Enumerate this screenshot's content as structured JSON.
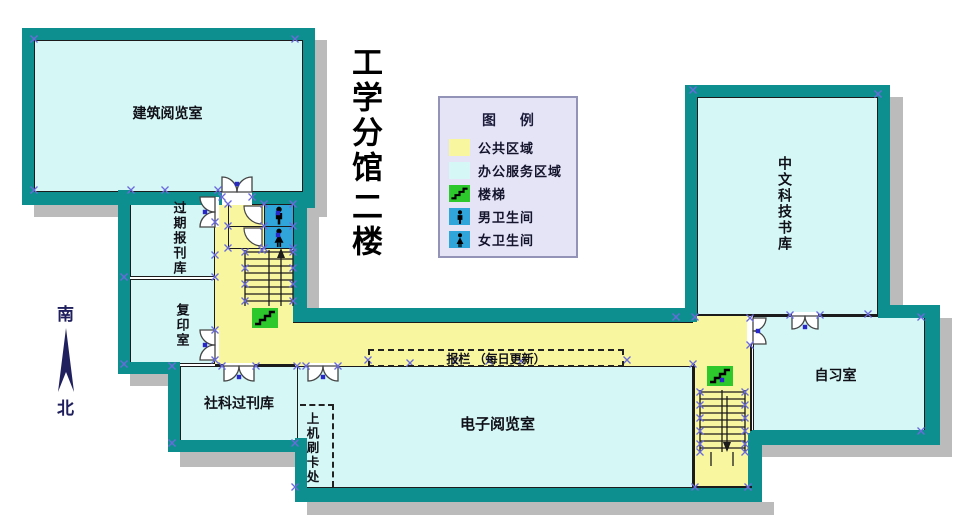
{
  "title": {
    "line1": "工学分馆",
    "line2": "二楼"
  },
  "compass": {
    "south": "南",
    "north": "北"
  },
  "legend": {
    "title": "图 例",
    "items": [
      {
        "id": "public-area",
        "label": "公共区域"
      },
      {
        "id": "office-service-area",
        "label": "办公服务区域"
      },
      {
        "id": "stairs",
        "label": "楼梯"
      },
      {
        "id": "male-restroom",
        "label": "男卫生间"
      },
      {
        "id": "female-restroom",
        "label": "女卫生间"
      }
    ]
  },
  "rooms": {
    "architecture_reading": "建筑阅览室",
    "expired_periodicals": "过期报刊库",
    "copy_room": "复印室",
    "social_science_periodicals": "社科过刊库",
    "computer_card_swipe": "上机刷卡处",
    "electronic_reading": "电子阅览室",
    "self_study": "自习室",
    "chinese_scitech_stacks": "中文科技书库"
  },
  "annotations": {
    "newspaper_board": "报栏 （每日更新）"
  },
  "colors": {
    "wall": "#0E8F8F",
    "room_fill": "#D5F8F6",
    "corridor_fill": "#F9F6A0",
    "legend_bg": "#E5E4F7",
    "restroom_blue": "#2FA5D9",
    "stairs_green": "#2CC82C",
    "shadow_gray": "#BBBBBB",
    "marker_blue": "#6A6ADD",
    "compass_navy": "#20205E"
  }
}
